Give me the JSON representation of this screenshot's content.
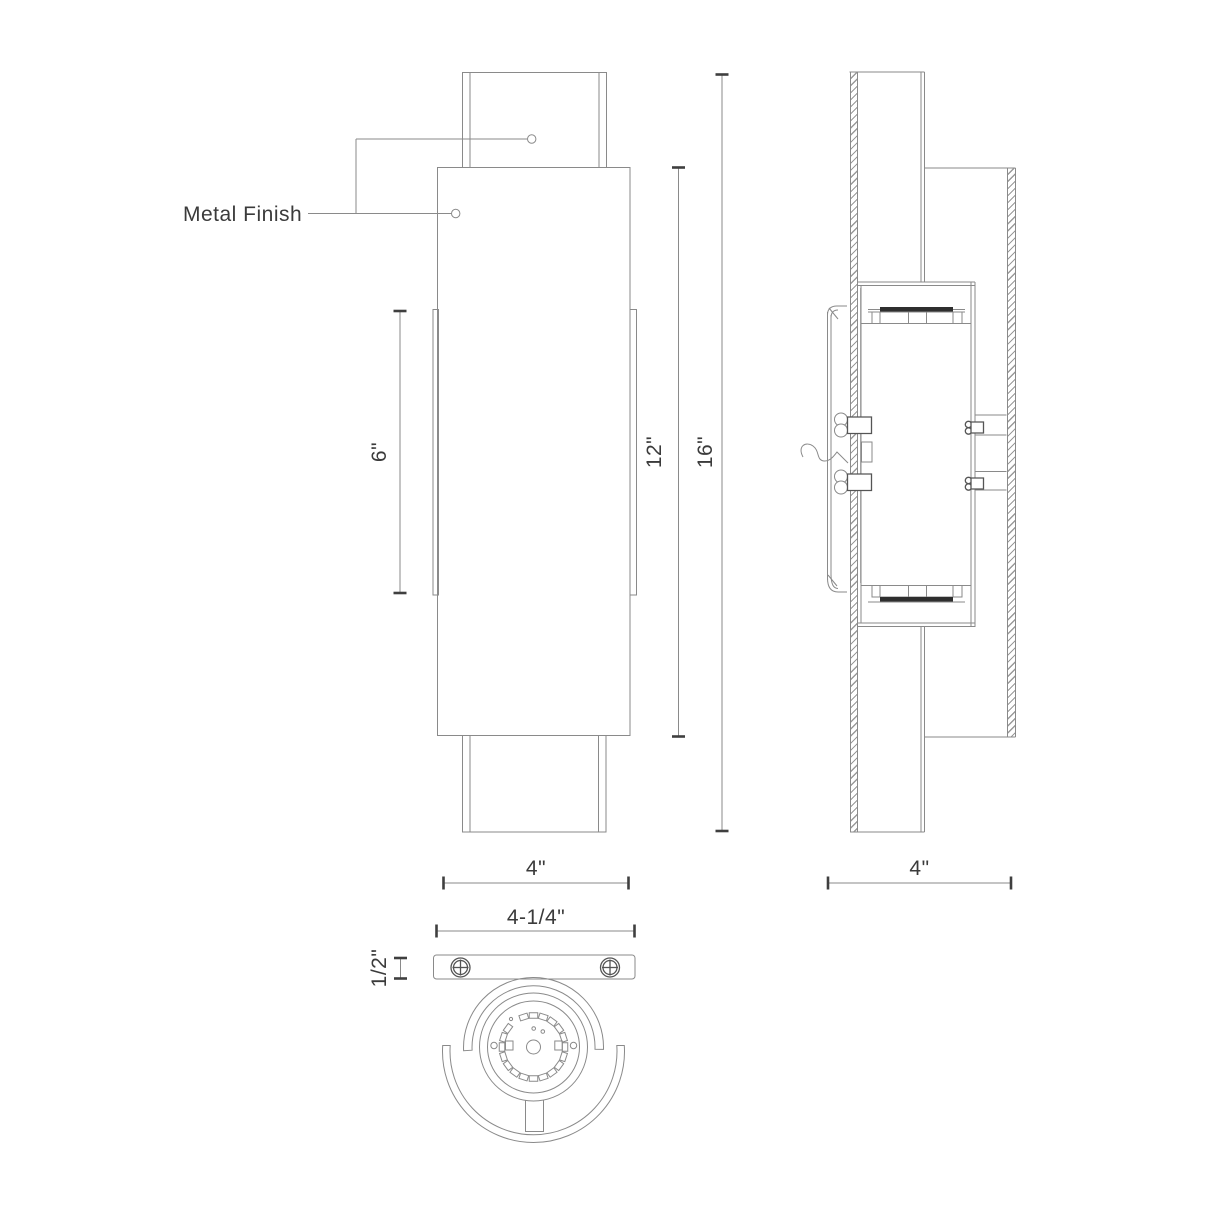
{
  "page": {
    "title": "Wall Sconce Dimension Drawing"
  },
  "colors": {
    "line": "#8a8a8a",
    "dark": "#3f3f3f",
    "text": "#3b3b3b",
    "hatch": "#9a9a9a",
    "fill": "#ffffff",
    "led_bar": "#2e2e2e",
    "bg": "#ffffff"
  },
  "annotations": {
    "metal_finish": "Metal Finish"
  },
  "views": {
    "front": {
      "dims": {
        "fin_height": "6\"",
        "body_height": "12\"",
        "overall_height": "16\"",
        "width": "4\""
      }
    },
    "side": {
      "dims": {
        "depth": "4\""
      }
    },
    "bottom": {
      "dims": {
        "backplate_width": "4-1/4\"",
        "backplate_thickness": "1/2\""
      }
    }
  }
}
